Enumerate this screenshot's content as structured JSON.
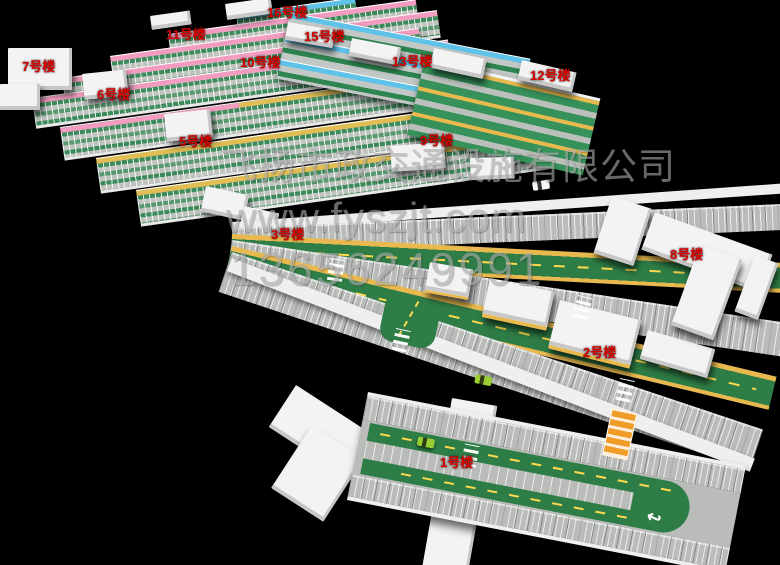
{
  "watermark": {
    "company": "飞扬市政交通设施有限公司",
    "website": "www.fyszjt.com",
    "phone": "13656249991",
    "color": "#a8a8a8"
  },
  "labels": [
    {
      "text": "1号楼"
    },
    {
      "text": "2号楼"
    },
    {
      "text": "3号楼"
    },
    {
      "text": "5号楼"
    },
    {
      "text": "6号楼"
    },
    {
      "text": "7号楼"
    },
    {
      "text": "8号楼"
    },
    {
      "text": "9号楼"
    },
    {
      "text": "10号楼"
    },
    {
      "text": "11号楼"
    },
    {
      "text": "12号楼"
    },
    {
      "text": "13号楼"
    },
    {
      "text": "15号楼"
    },
    {
      "text": "16号楼"
    }
  ],
  "icons": {
    "u_turn_arrow": "↩"
  },
  "colors": {
    "background": "#000000",
    "label_red": "#d40000",
    "pink_wall": "#f29dc0",
    "cyan_wall": "#5fc3e9",
    "gold_wall": "#e7b94f",
    "green_floor": "#2e7d46",
    "stall_gray": "#b9bcb9",
    "white_structure": "#f3f3f3",
    "ramp_orange": "#f09c28"
  }
}
